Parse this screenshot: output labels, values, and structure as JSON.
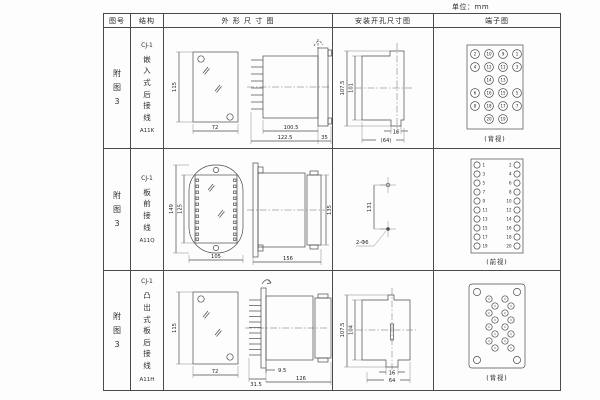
{
  "unit_label": "单位：mm",
  "table": {
    "headers": [
      "图号",
      "结构",
      "外 形 尺 寸 图",
      "安装开孔尺寸图",
      "端子图"
    ]
  },
  "rows": [
    {
      "fig_no": "附图3",
      "model": "CJ-1",
      "mount": "嵌入式后接线",
      "code": "A11K",
      "outline": {
        "height": "115",
        "width": "72",
        "body_len": "100.5",
        "total_len": "122.5",
        "flange_w": "35"
      },
      "install": {
        "outer_h": "107.5",
        "inner_h": "101",
        "slot_w": "16",
        "total_w": "(64)"
      },
      "terminal_caption": "(背视)"
    },
    {
      "fig_no": "附图3",
      "model": "CJ-1",
      "mount": "板前接线",
      "code": "A11Q",
      "outline": {
        "outer_h": "149",
        "inner_h": "125",
        "width": "105",
        "length": "156",
        "height": "135"
      },
      "install": {
        "spacing": "131",
        "holes": "2-Φ6"
      },
      "terminal_caption": "(前视)"
    },
    {
      "fig_no": "附图3",
      "model": "CJ-1",
      "mount": "凸出式板后接线",
      "code": "A11H",
      "outline": {
        "height": "115",
        "width": "72",
        "pin_len": "31.5",
        "offset": "9.5",
        "body_len": "126"
      },
      "install": {
        "outer_h": "107.5",
        "inner_h": "104",
        "slot_w": "16",
        "total_w": "64"
      },
      "terminal_caption": "(背视)"
    }
  ],
  "terminals": {
    "rear_grid": [
      [
        "2",
        "10",
        "9",
        "1"
      ],
      [
        "4",
        "12",
        "11",
        "3"
      ],
      [
        "14",
        "13"
      ],
      [
        "6",
        "16",
        "15",
        "5"
      ],
      [
        "8",
        "18",
        "17",
        "7"
      ],
      [
        "20",
        "19"
      ]
    ],
    "front_left": [
      "1",
      "3",
      "5",
      "7",
      "9",
      "11",
      "13",
      "15",
      "17",
      "19"
    ],
    "front_right": [
      "2",
      "4",
      "6",
      "8",
      "10",
      "12",
      "14",
      "16",
      "18",
      "20"
    ]
  }
}
